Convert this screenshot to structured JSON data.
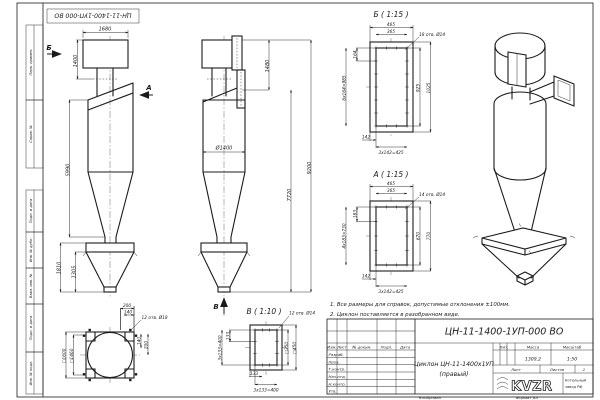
{
  "doc": {
    "stamp_top": "ЦН-11-1400-1УП-000 ВО",
    "kopiroval": "Копировал",
    "format": "Формат А3"
  },
  "margin": {
    "labels": [
      "Перв. примен.",
      "Справ. №",
      "Подп. и дата",
      "Инв. № дубл.",
      "Взам. инв. №",
      "Подп. и дата",
      "Инв. № подл."
    ]
  },
  "front": {
    "sec_b": "Б",
    "sec_a": "А",
    "w_top": "1680",
    "h_top": "1400",
    "h_body": "5990",
    "h_bunker": "1810",
    "h_cone": "1305"
  },
  "side": {
    "sec_v": "В",
    "h_top": "1480",
    "h_mid": "7720",
    "h_total": "9200",
    "dia": "Ø1400"
  },
  "viewB": {
    "title": "Б ( 1:15 )",
    "holes": "18 отв. Ø14",
    "w1": "465",
    "w2": "365",
    "p1": "164",
    "pitch": "6х164=985",
    "h_in": "925",
    "h_out": "1025",
    "off": "142",
    "pitch_b": "3х142=425"
  },
  "viewA": {
    "title": "А ( 1:15 )",
    "holes": "14 отв. Ø14",
    "w1": "465",
    "w2": "365",
    "p1": "183",
    "pitch": "4х183=730",
    "h_in": "670",
    "h_out": "770",
    "off": "142",
    "pitch_b": "3х142=425"
  },
  "base": {
    "holes": "12 отв. Ø18",
    "d1": "200",
    "d2": "140",
    "sq_out": "□1600",
    "sq_in": "□1460",
    "r1": "140",
    "r2": "200"
  },
  "viewV": {
    "title": "В ( 1:10 )",
    "holes": "12 отв. Ø14",
    "p1": "133",
    "pitch": "3х133=400",
    "sq_in": "□350",
    "sq_out": "□450",
    "off": "133",
    "pitch_b": "3х133=400"
  },
  "notes": {
    "n1": "1. Все размеры для справок, допустимые отклонения ±100мм.",
    "n2": "2. Циклон поставляется в разобранном виде."
  },
  "tb": {
    "doc_number": "ЦН-11-1400-1УП-000 ВО",
    "name1": "Циклон ЦН-11-1400х1УП",
    "name2": "(правый)",
    "lit": "Лит.",
    "mass": "Масса",
    "scale": "Масштаб",
    "mass_val": "1309,2",
    "scale_val": "1:50",
    "sheet": "Лист",
    "sheets": "Листов",
    "sheets_val": "1",
    "h_izm": "Изм.",
    "h_list": "Лист",
    "h_doc": "№ докум.",
    "h_podp": "Подп.",
    "h_data": "Дата",
    "r1": "Разраб.",
    "r2": "Пров.",
    "r3": "Т.контр.",
    "r4": "Нач.отд.",
    "r5": "Н.контр.",
    "r6": "Утв.",
    "logo": "KVZR",
    "co1": "Котельный",
    "co2": "завод РФ"
  }
}
